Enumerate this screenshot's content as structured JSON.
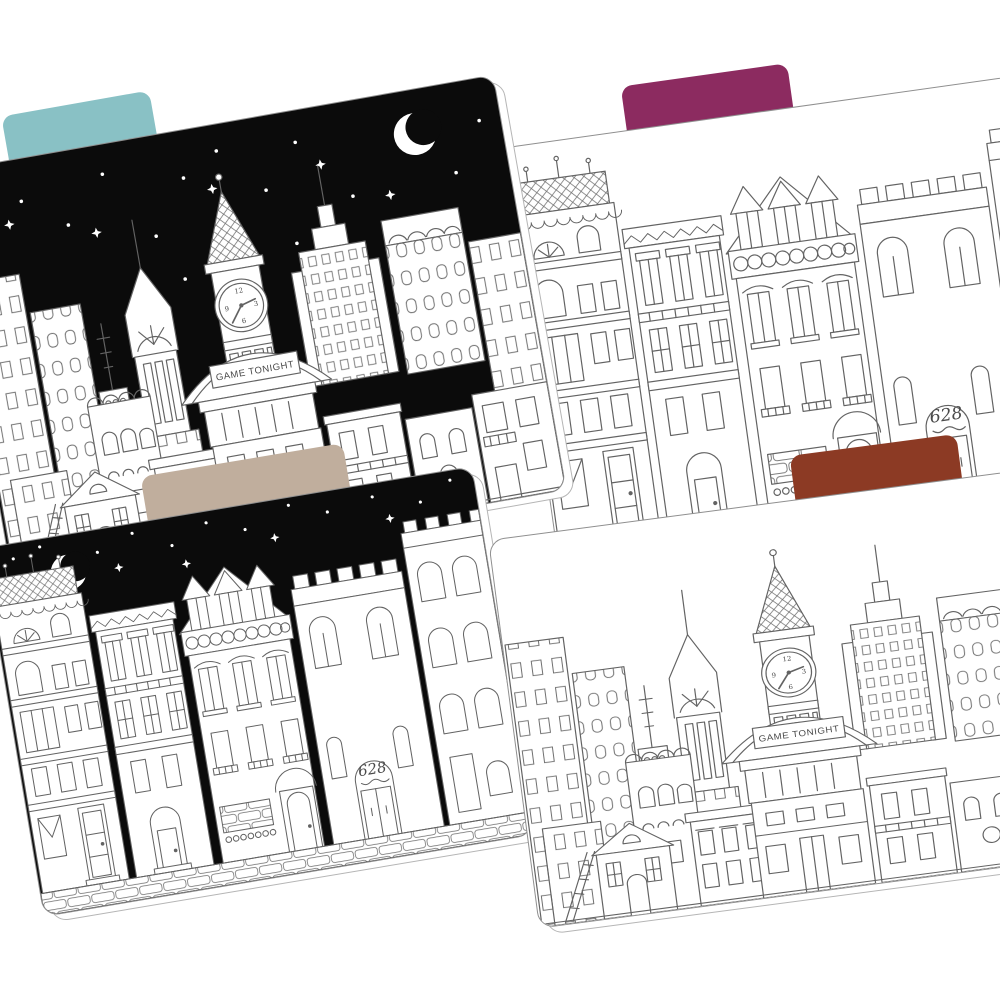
{
  "page": {
    "background_color": "#ffffff"
  },
  "folders": [
    {
      "label": "night city skyline folder",
      "position": "top-left",
      "artwork": "city skyline",
      "sky": "night",
      "decorations": "stars and crescent moon",
      "tab": {
        "color": "#89c1c5",
        "position": "left"
      }
    },
    {
      "label": "white row houses folder",
      "position": "top-right",
      "artwork": "victorian row houses",
      "sky": "day",
      "tab": {
        "color": "#8c2b60",
        "position": "center"
      }
    },
    {
      "label": "night row houses folder",
      "position": "bottom-left",
      "artwork": "victorian row houses",
      "sky": "night",
      "decorations": "stars and crescent moon",
      "tab": {
        "color": "#c0ae9d",
        "position": "center-left"
      }
    },
    {
      "label": "white city skyline folder",
      "position": "bottom-right",
      "artwork": "city skyline",
      "sky": "day",
      "tab": {
        "color": "#8c3a24",
        "position": "right"
      }
    }
  ],
  "artwork": {
    "banner_text": "GAME TONIGHT",
    "door_number": "628",
    "clock_numerals": {
      "top": "12",
      "right": "3",
      "bottom": "6",
      "left": "9"
    },
    "line_color": "#636363",
    "night_sky": "#0b0b0b",
    "building_fill": "#ffffff"
  }
}
